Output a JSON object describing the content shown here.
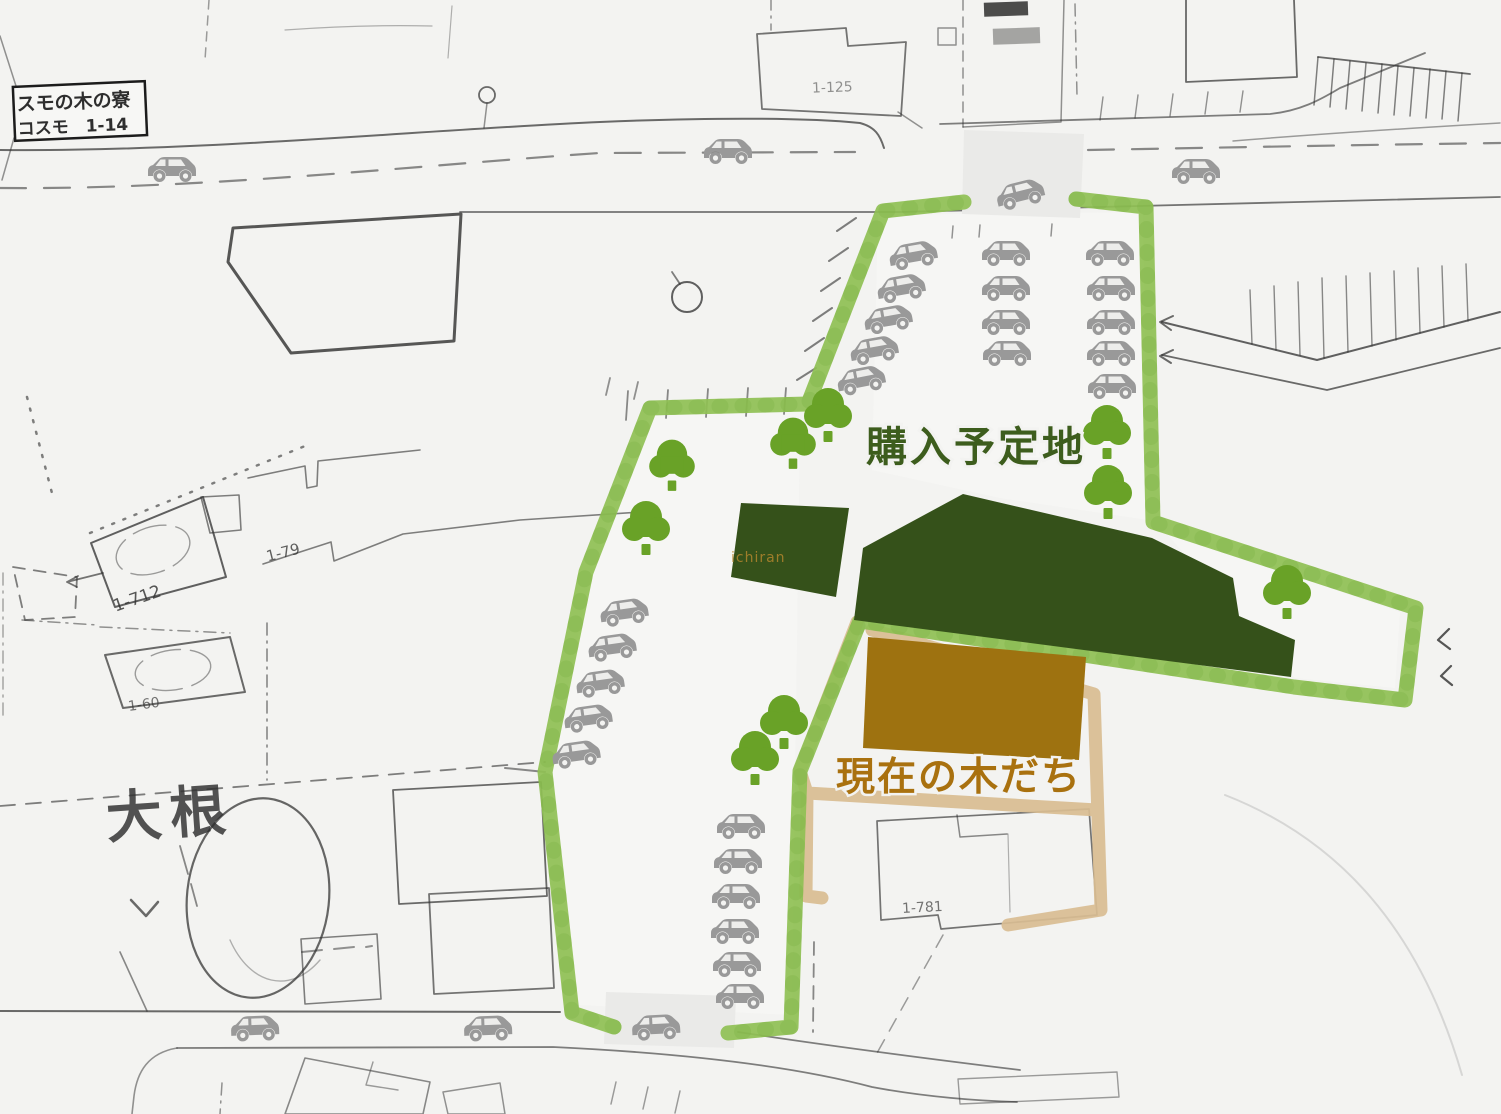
{
  "colors": {
    "paper": "#f3f3f1",
    "road_patch": "#eaeae8",
    "interior_light": "#f8f8f6",
    "map_ink": "#2e2e2e",
    "boundary_green": "#8fc054",
    "boundary_green_dark": "#7cae41",
    "forest_dark_green": "#35511a",
    "building_brown": "#9e7210",
    "grove_outline_tan": "#d9bd92",
    "car_gray": "#999999",
    "car_window": "#ededeb",
    "tree_green": "#69a227",
    "purchase_text_green": "#3d5d1d",
    "grove_text_brown": "#a9710f",
    "watermark_brown": "#b9882e"
  },
  "labels": {
    "purchase_site": "購入予定地",
    "current_grove": "現在の木だち",
    "watermark": "ichiran"
  },
  "map_labels": {
    "facility_box_line1": "スモの木の寮",
    "facility_box_line2": "コスモ　1-14",
    "plot_125": "1-125",
    "plot_79": "1-79",
    "plot_712": "1-712",
    "plot_60": "1-60",
    "plot_781": "1-781",
    "area_daikon": "大根"
  },
  "cars": [
    {
      "x": 172,
      "y": 168,
      "r": 0
    },
    {
      "x": 728,
      "y": 150,
      "r": 0
    },
    {
      "x": 1020,
      "y": 193,
      "r": -14
    },
    {
      "x": 1196,
      "y": 170,
      "r": 0
    },
    {
      "x": 913,
      "y": 254,
      "r": -10
    },
    {
      "x": 901,
      "y": 287,
      "r": -10
    },
    {
      "x": 888,
      "y": 318,
      "r": -10
    },
    {
      "x": 874,
      "y": 349,
      "r": -10
    },
    {
      "x": 861,
      "y": 379,
      "r": -11
    },
    {
      "x": 1006,
      "y": 252,
      "r": 0
    },
    {
      "x": 1006,
      "y": 287,
      "r": 0
    },
    {
      "x": 1006,
      "y": 321,
      "r": 0
    },
    {
      "x": 1007,
      "y": 352,
      "r": 0
    },
    {
      "x": 1110,
      "y": 252,
      "r": 0
    },
    {
      "x": 1111,
      "y": 287,
      "r": 0
    },
    {
      "x": 1111,
      "y": 321,
      "r": 0
    },
    {
      "x": 1111,
      "y": 352,
      "r": 0
    },
    {
      "x": 1112,
      "y": 385,
      "r": 0
    },
    {
      "x": 624,
      "y": 611,
      "r": -8
    },
    {
      "x": 612,
      "y": 646,
      "r": -8
    },
    {
      "x": 600,
      "y": 682,
      "r": -8
    },
    {
      "x": 588,
      "y": 717,
      "r": -8
    },
    {
      "x": 576,
      "y": 753,
      "r": -8
    },
    {
      "x": 741,
      "y": 825,
      "r": 0
    },
    {
      "x": 738,
      "y": 860,
      "r": 0
    },
    {
      "x": 736,
      "y": 895,
      "r": 0
    },
    {
      "x": 735,
      "y": 930,
      "r": 0
    },
    {
      "x": 737,
      "y": 963,
      "r": 0
    },
    {
      "x": 740,
      "y": 995,
      "r": 0
    },
    {
      "x": 255,
      "y": 1027,
      "r": -2
    },
    {
      "x": 488,
      "y": 1027,
      "r": -2
    },
    {
      "x": 656,
      "y": 1026,
      "r": -3
    }
  ],
  "trees": [
    {
      "x": 828,
      "y": 420,
      "s": 1
    },
    {
      "x": 793,
      "y": 448,
      "s": 0.95
    },
    {
      "x": 672,
      "y": 470,
      "s": 0.95
    },
    {
      "x": 646,
      "y": 533,
      "s": 1
    },
    {
      "x": 1107,
      "y": 437,
      "s": 1
    },
    {
      "x": 1108,
      "y": 497,
      "s": 1
    },
    {
      "x": 1287,
      "y": 597,
      "s": 1
    },
    {
      "x": 784,
      "y": 727,
      "s": 1
    },
    {
      "x": 755,
      "y": 763,
      "s": 1
    }
  ]
}
